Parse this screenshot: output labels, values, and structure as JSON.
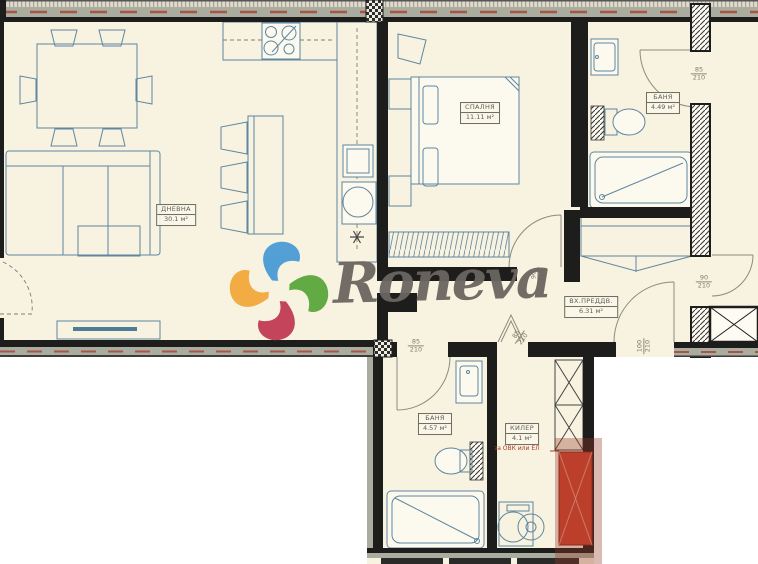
{
  "watermark": {
    "brand": "Roneva",
    "logo_colors": {
      "blue": "#4a9bd5",
      "green": "#5aa83c",
      "red": "#c23b55",
      "orange": "#f2a93b"
    },
    "text_color": "#6b6561"
  },
  "rooms": [
    {
      "id": "living-room",
      "name": "ДНЕВНА",
      "area": "30.1 м²"
    },
    {
      "id": "bedroom",
      "name": "СПАЛНЯ",
      "area": "11.11 м²"
    },
    {
      "id": "bathroom-1",
      "name": "БАНЯ",
      "area": "4.49 м²"
    },
    {
      "id": "entry-hall",
      "name": "ВХ.ПРЕДДВ.",
      "area": "6.31 м²"
    },
    {
      "id": "bathroom-2",
      "name": "БАНЯ",
      "area": "4.57 м²"
    },
    {
      "id": "closet",
      "name": "КИЛЕР",
      "area": "4.1 м²"
    }
  ],
  "door_dimensions": [
    {
      "id": "bathroom1-door",
      "width": "85",
      "height": "210"
    },
    {
      "id": "bedroom-door",
      "width": "90",
      "height": "210"
    },
    {
      "id": "right-room-door",
      "width": "90",
      "height": "210"
    },
    {
      "id": "entrance-door",
      "width": "100",
      "height": "210"
    },
    {
      "id": "bathroom2-door",
      "width": "85",
      "height": "210"
    },
    {
      "id": "closet-door",
      "width": "85",
      "height": "210"
    }
  ],
  "annotations": [
    {
      "id": "shaft-note",
      "text": "за ОВК или ЕЛ",
      "color": "#b0372a"
    }
  ],
  "colors": {
    "interior": "#f8f3e0",
    "wall": "#1d1d1b",
    "insulation_band": "#a9ac9f",
    "furniture_line": "#5e86a0",
    "red_zone": "#d0422e"
  }
}
